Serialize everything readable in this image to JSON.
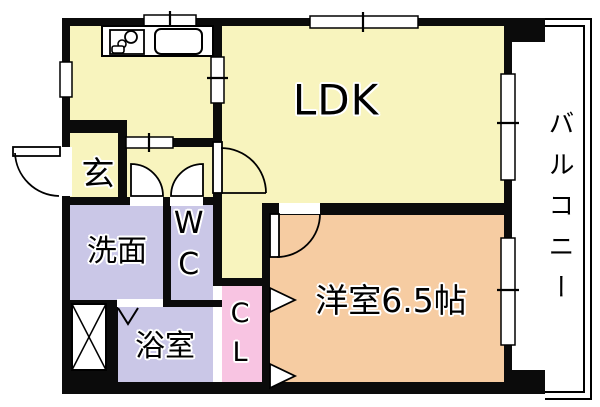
{
  "title": "apartment-floor-plan",
  "rooms": {
    "ldk": {
      "label": "LDK"
    },
    "genkan": {
      "label": "玄"
    },
    "washroom": {
      "label": "洗面"
    },
    "toilet": {
      "label": "WC"
    },
    "bathroom": {
      "label": "浴室"
    },
    "closet": {
      "label": "CL"
    },
    "western_room": {
      "label": "洋室6.5帖",
      "size_tatami": "6.5帖"
    },
    "balcony": {
      "label": "バルコニー"
    }
  },
  "colors": {
    "room_yellow": "#F8F4BE",
    "room_lavender": "#CAC7E7",
    "room_pink": "#F8C4E2",
    "room_peach": "#F6CCA2",
    "wall": "#0B0B0B",
    "floor_white": "#FFFFFF",
    "line": "#000000"
  },
  "icons": {
    "stove": "stove-burners-icon",
    "sink": "kitchen-sink-icon",
    "pipe_space": "pipe-space-x-icon",
    "swing_door": "door-swing-arc-icon",
    "fold_door": "folding-door-chevron-icon",
    "window": "sliding-window-icon",
    "railing": "balcony-railing-icon"
  }
}
